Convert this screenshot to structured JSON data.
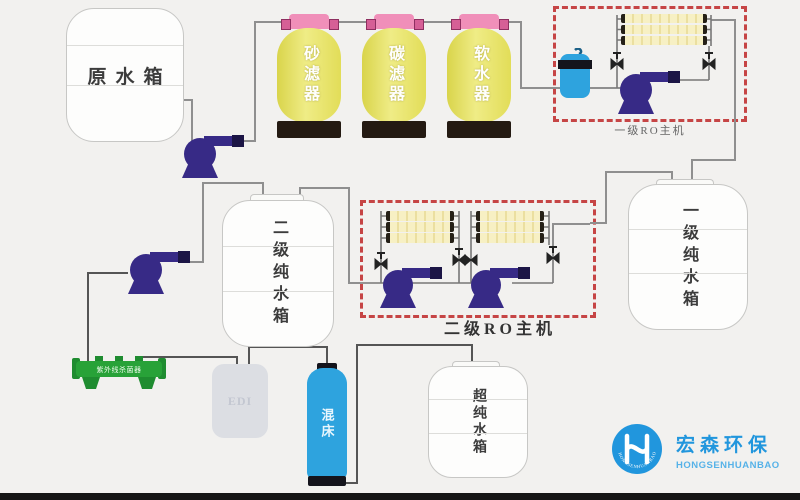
{
  "diagram_title": "纯水处理工艺流程图",
  "tanks": {
    "raw_water": {
      "label": "原水箱"
    },
    "stage2_pure": {
      "label": "二级纯水箱"
    },
    "stage1_pure": {
      "label": "一级纯水箱"
    },
    "ultra_pure": {
      "label": "超纯水箱"
    },
    "edi": {
      "label": "EDI"
    },
    "mixed_bed": {
      "label": "混床"
    }
  },
  "filters": [
    {
      "label": "砂滤器"
    },
    {
      "label": "碳滤器"
    },
    {
      "label": "软水器"
    }
  ],
  "ro_units": {
    "stage1": {
      "label": "一级RO主机"
    },
    "stage2": {
      "label": "二级RO主机"
    }
  },
  "uv_sterilizer": {
    "label": "紫外线杀菌器"
  },
  "logo": {
    "name_cn": "宏森环保",
    "name_en": "HONGSENHUANBAO",
    "circle_text": "HONGSENHUANBAO"
  },
  "colors": {
    "background": "#f2f1ef",
    "pipe_gray": "#8f8f8f",
    "dashed_red": "#c64545",
    "filter_yellow": "#e8e36a",
    "cap_pink": "#f08fb9",
    "pump_indigo": "#372a86",
    "water_blue": "#2ea3de",
    "uv_green": "#28a238",
    "logo_blue": "#2196dd"
  }
}
